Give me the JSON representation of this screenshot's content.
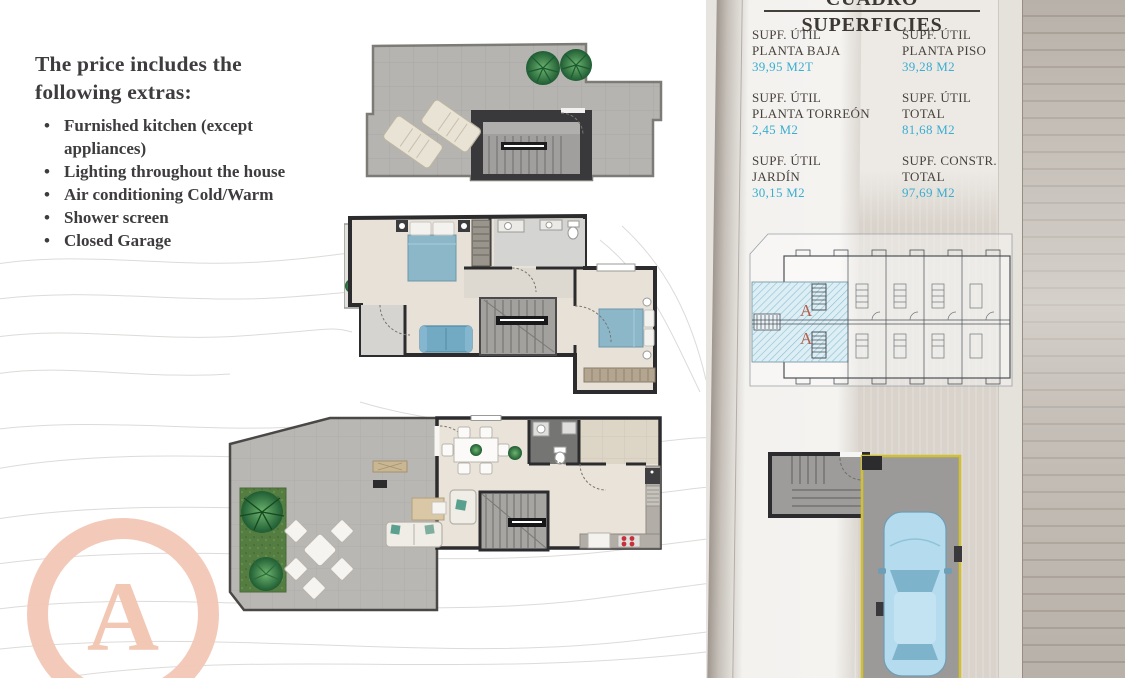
{
  "extras": {
    "heading": "The price includes the following extras:",
    "items": [
      "Furnished kitchen (except appliances)",
      "Lighting throughout the house",
      "Air conditioning Cold/Warm",
      "Shower screen",
      "Closed Garage"
    ]
  },
  "superficies": {
    "title": "CUADRO SUPERFICIES",
    "cells": [
      {
        "label1": "SUPF. ÚTIL",
        "label2": "PLANTA BAJA",
        "value": "39,95 M2T"
      },
      {
        "label1": "SUPF. ÚTIL",
        "label2": "PLANTA PISO",
        "value": "39,28 M2"
      },
      {
        "label1": "SUPF. ÚTIL",
        "label2": "PLANTA TORREÓN",
        "value": "2,45 M2"
      },
      {
        "label1": "SUPF. ÚTIL",
        "label2": "TOTAL",
        "value": "81,68 M2"
      },
      {
        "label1": "SUPF. ÚTIL",
        "label2": "JARDÍN",
        "value": "30,15 M2"
      },
      {
        "label1": "SUPF. CONSTR.",
        "label2": "TOTAL",
        "value": "97,69 M2"
      }
    ]
  },
  "site_plan": {
    "unit_label_top": "A",
    "unit_label_bottom": "A"
  },
  "watermark": {
    "letter": "A"
  },
  "colors": {
    "value_blue": "#3badcf",
    "text_dark": "#3e3c3e",
    "watermark_salmon": "#f2c5b2",
    "unit_label_red": "#b4604e",
    "unit_hatch_blue": "#ddeef5",
    "garage_outline_yellow": "#d2c033",
    "car_blue": "#b4dbee",
    "bed_blue": "#8cb7c9",
    "wall_dark": "#2c2c2e"
  }
}
